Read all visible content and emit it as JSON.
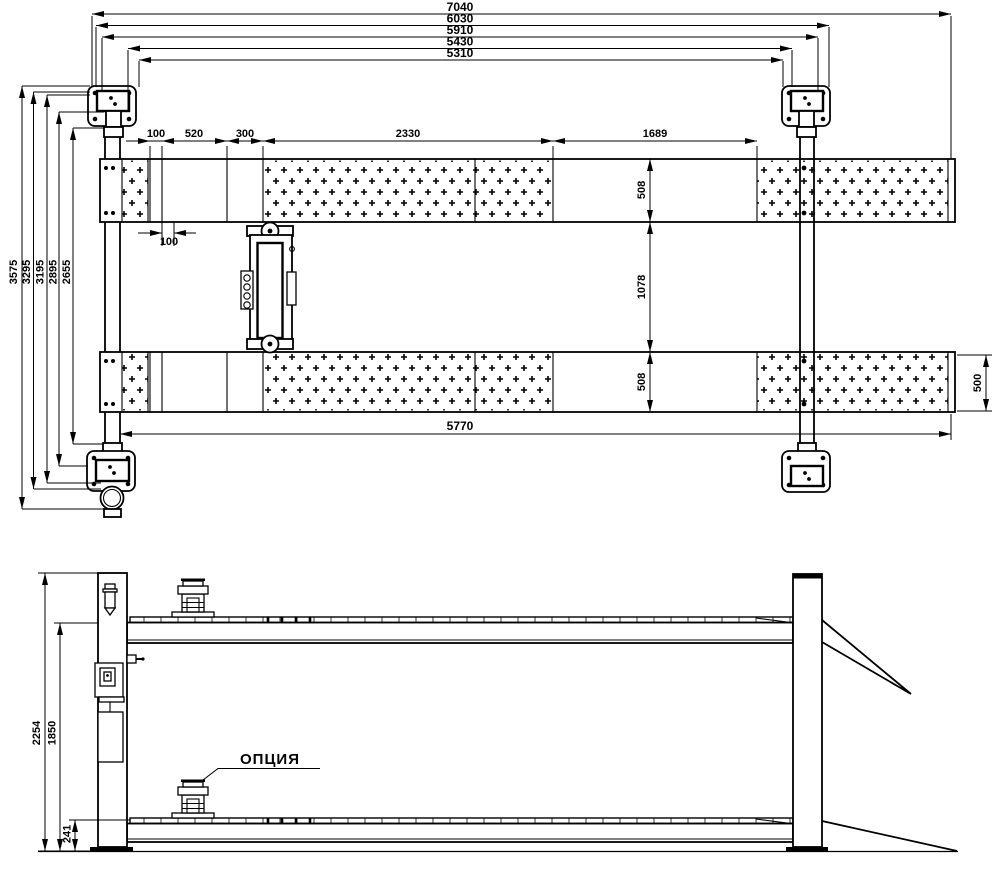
{
  "plan": {
    "top_dims": [
      "7040",
      "6030",
      "5910",
      "5430",
      "5310"
    ],
    "chain_dims": [
      "100",
      "520",
      "300",
      "2330",
      "1689"
    ],
    "left_dims": [
      "3575",
      "3295",
      "3195",
      "2895",
      "2655"
    ],
    "width_dims": [
      "508",
      "1078",
      "508"
    ],
    "right_width_dim": "500",
    "offset_dim": "100",
    "base_length_dim": "5770"
  },
  "side": {
    "height_dims": [
      "2254",
      "1850",
      "241"
    ],
    "option_label": "ОПЦИЯ"
  }
}
